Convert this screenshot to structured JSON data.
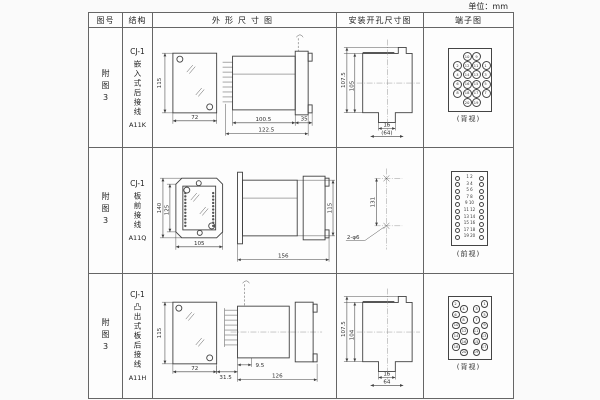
{
  "unit_label": "单位：mm",
  "table": {
    "headers": {
      "figure_no": "图号",
      "structure": "结构",
      "outline": "外形尺寸图",
      "mounting": "安装开孔尺寸图",
      "terminal": "端子图"
    },
    "rows": [
      {
        "figure_no": "附图3",
        "model": "CJ-1",
        "mount_type": "嵌入式后接线",
        "code": "A11K",
        "outline": {
          "front_height": "115",
          "front_width": "72",
          "body_depth": "100.5",
          "flange_depth": "35",
          "total_depth": "122.5"
        },
        "mounting": {
          "outer_height": "107.5",
          "inner_height": "105",
          "slot_width": "16",
          "span": "(64)"
        },
        "terminal": {
          "pattern": "quad",
          "view_label": "(背视)",
          "rows": [
            [
              "10",
              "9"
            ],
            [
              "2",
              "12",
              "11",
              "1"
            ],
            [
              "4",
              "14",
              "13",
              "3"
            ],
            [
              "6",
              "16",
              "15",
              "5"
            ],
            [
              "8",
              "18",
              "17",
              "7"
            ],
            [
              "20",
              "19"
            ]
          ]
        }
      },
      {
        "figure_no": "附图3",
        "model": "CJ-1",
        "mount_type": "板前接线",
        "code": "A11Q",
        "outline": {
          "front_outer_height": "140",
          "front_inner_height": "125",
          "front_width": "105",
          "body_depth": "156",
          "body_height": "115"
        },
        "mounting": {
          "hole_spacing": "131",
          "hole_label": "2-φ6"
        },
        "terminal": {
          "pattern": "pairs",
          "view_label": "(前视)",
          "rows": [
            [
              "1",
              "2"
            ],
            [
              "3",
              "4"
            ],
            [
              "5",
              "6"
            ],
            [
              "7",
              "8"
            ],
            [
              "9",
              "10"
            ],
            [
              "11",
              "12"
            ],
            [
              "13",
              "14"
            ],
            [
              "15",
              "16"
            ],
            [
              "17",
              "18"
            ],
            [
              "19",
              "20"
            ]
          ]
        }
      },
      {
        "figure_no": "附图3",
        "model": "CJ-1",
        "mount_type": "凸出式板后接线",
        "code": "A11H",
        "outline": {
          "front_height": "115",
          "front_width": "72",
          "pin_depth": "31.5",
          "stub_depth": "9.5",
          "body_depth": "126"
        },
        "mounting": {
          "outer_height": "107.5",
          "inner_height": "104",
          "slot_width": "16",
          "span": "64"
        },
        "terminal": {
          "pattern": "zigzag",
          "view_label": "(背视)",
          "left": [
            "2",
            "4",
            "6",
            "8",
            "10",
            "12",
            "14",
            "16",
            "18",
            "20"
          ],
          "right": [
            "1",
            "3",
            "5",
            "7",
            "9",
            "11",
            "13",
            "15",
            "17",
            "19"
          ]
        }
      }
    ]
  }
}
